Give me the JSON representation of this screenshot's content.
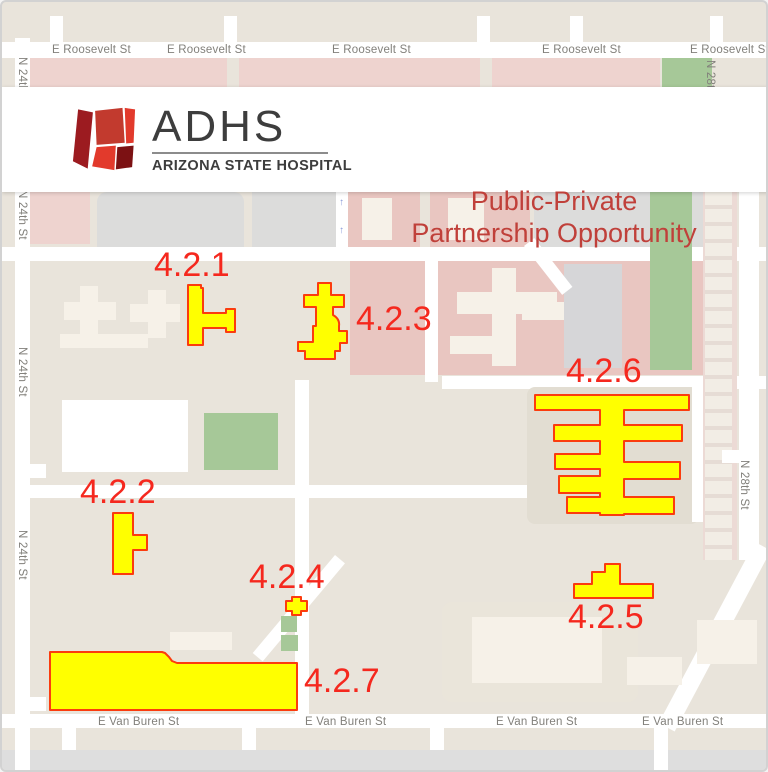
{
  "header": {
    "logo": {
      "abbr": "ADHS",
      "name": "ARIZONA STATE HOSPITAL"
    },
    "title_line1": "Public-Private",
    "title_line2": "Partnership Opportunity"
  },
  "streets": {
    "roosevelt": "E Roosevelt St",
    "van_buren": "E Van Buren St",
    "n24": "N 24th St",
    "n28": "N 28th St"
  },
  "highlights": [
    {
      "label": "4.2.1"
    },
    {
      "label": "4.2.2"
    },
    {
      "label": "4.2.3"
    },
    {
      "label": "4.2.4"
    },
    {
      "label": "4.2.5"
    },
    {
      "label": "4.2.6"
    },
    {
      "label": "4.2.7"
    }
  ],
  "colors": {
    "highlight_fill": "#ffff00",
    "highlight_stroke": "#fb3c0e",
    "label_red": "#f5281e",
    "title_red": "#c0403a"
  },
  "icons": {
    "one_way_arrow": "↑"
  }
}
